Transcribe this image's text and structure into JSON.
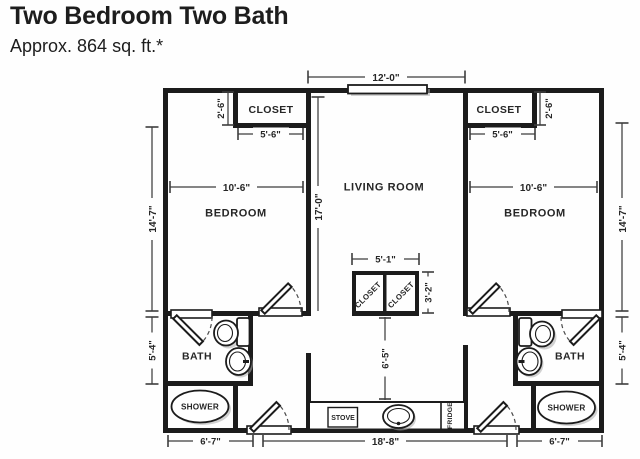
{
  "header": {
    "title": "Two Bedroom Two Bath",
    "subtitle": "Approx. 864 sq. ft.*"
  },
  "plan": {
    "rooms": {
      "living_room": "LIVING ROOM",
      "bedroom_left": "BEDROOM",
      "bedroom_right": "BEDROOM",
      "closet_left": "CLOSET",
      "closet_right": "CLOSET",
      "hall_closet_left": "CLOSET",
      "hall_closet_right": "CLOSET",
      "bath_left": "BATH",
      "bath_right": "BATH",
      "shower_left": "SHOWER",
      "shower_right": "SHOWER"
    },
    "appliances": {
      "stove": "STOVE",
      "fridge": "FRIDGE"
    },
    "dimensions": {
      "living_room_width": "12'-0\"",
      "living_room_depth": "17'-0\"",
      "bedroom_left_width": "10'-6\"",
      "bedroom_right_width": "10'-6\"",
      "bedroom_left_depth": "14'-7\"",
      "bedroom_right_depth": "14'-7\"",
      "closet_left_depth": "2'-6\"",
      "closet_right_depth": "2'-6\"",
      "closet_left_width": "5'-6\"",
      "closet_right_width": "5'-6\"",
      "hall_closet_width": "5'-1\"",
      "hall_closet_depth": "3'-2\"",
      "hall_depth": "6'-5\"",
      "bath_left_depth": "5'-4\"",
      "bath_right_depth": "5'-4\"",
      "bath_left_width": "6'-7\"",
      "bath_right_width": "6'-7\"",
      "kitchen_span_width": "18'-8\""
    },
    "colors": {
      "wall_line": "#1c1c1c",
      "dimension_line": "#3d3d3d",
      "text": "#262626",
      "background": "#fefefe"
    }
  }
}
